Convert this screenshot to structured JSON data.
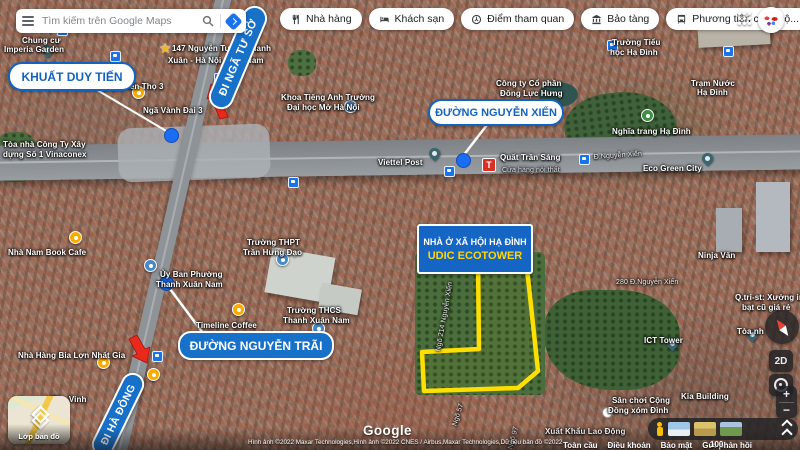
{
  "topbar": {
    "search_placeholder": "Tìm kiếm trên Google Maps",
    "chips": [
      {
        "icon": "restaurant-icon",
        "label": "Nhà hàng"
      },
      {
        "icon": "hotel-icon",
        "label": "Khách sạn"
      },
      {
        "icon": "attraction-icon",
        "label": "Điểm tham quan"
      },
      {
        "icon": "museum-icon",
        "label": "Bảo tàng"
      },
      {
        "icon": "transit-icon",
        "label": "Phương tiện công cộ..."
      }
    ],
    "more_label": "›"
  },
  "annotations": {
    "khuat_duy_tien": "KHUẤT DUY TIẾN",
    "di_nga_tu_so": "ĐI NGÃ TƯ SỞ",
    "duong_nguyen_xien": "ĐƯỜNG NGUYỄN XIỂN",
    "udic_line1": "NHÀ Ở XÃ HỘI HẠ ĐÌNH",
    "udic_line2": "UDIC ECOTOWER",
    "duong_nguyen_trai": "ĐƯỜNG NGUYỄN TRÃI",
    "di_ha_dong": "ĐI HÀ ĐÔNG"
  },
  "map_labels": [
    {
      "text": "Chung cư",
      "x": 22,
      "y": 36
    },
    {
      "text": "Imperia Garden",
      "x": 4,
      "y": 45
    },
    {
      "text": "Nhà sách Tiến Thọ 3",
      "x": 84,
      "y": 82
    },
    {
      "text": "Ngã Vành Đai 3",
      "x": 143,
      "y": 106
    },
    {
      "text": "Tòa nhà Công Ty Xây",
      "x": 3,
      "y": 140
    },
    {
      "text": "dựng Số 1 Vinaconex",
      "x": 3,
      "y": 150
    },
    {
      "text": "147 Nguyễn Tuân - Thanh",
      "x": 172,
      "y": 44
    },
    {
      "text": "Xuân - Hà Nội - Việt Nam",
      "x": 168,
      "y": 56
    },
    {
      "text": "Nhà Nam Book Cafe",
      "x": 8,
      "y": 248
    },
    {
      "text": "Ủy Ban Phường",
      "x": 160,
      "y": 270
    },
    {
      "text": "Thanh Xuân Nam",
      "x": 156,
      "y": 280
    },
    {
      "text": "Trường THPT",
      "x": 247,
      "y": 238
    },
    {
      "text": "Trần Hưng Đạo",
      "x": 243,
      "y": 248
    },
    {
      "text": "Timeline Coffee",
      "x": 196,
      "y": 321
    },
    {
      "text": "Trường THCS",
      "x": 287,
      "y": 306
    },
    {
      "text": "Thanh Xuân Nam",
      "x": 283,
      "y": 316
    },
    {
      "text": "Nhà Hàng Bia Lợn Nhất Gia",
      "x": 18,
      "y": 351
    },
    {
      "text": "The Vinh",
      "x": 52,
      "y": 395
    },
    {
      "text": "Công ty Cổ phần",
      "x": 496,
      "y": 79
    },
    {
      "text": "Đồng Lực Hưng",
      "x": 500,
      "y": 89
    },
    {
      "text": "Khoa Tiếng Anh Trường",
      "x": 281,
      "y": 93
    },
    {
      "text": "Đại học Mở Hà Nội",
      "x": 287,
      "y": 103
    },
    {
      "text": "Trường Tiểu",
      "x": 612,
      "y": 38
    },
    {
      "text": "học Hạ Đình",
      "x": 610,
      "y": 48
    },
    {
      "text": "Nghĩa trang Hạ Đình",
      "x": 612,
      "y": 127
    },
    {
      "text": "Eco Green City",
      "x": 643,
      "y": 164
    },
    {
      "text": "Trạm Nước",
      "x": 691,
      "y": 79
    },
    {
      "text": "Hạ Đình",
      "x": 697,
      "y": 88
    },
    {
      "text": "Ninja Văn",
      "x": 698,
      "y": 251
    },
    {
      "text": "280 Đ.Nguyễn Xiển",
      "x": 616,
      "y": 279,
      "cls": "road"
    },
    {
      "text": "Q.tri-st: Xưởng in",
      "x": 735,
      "y": 293
    },
    {
      "text": "bạt cũ giá rẻ",
      "x": 742,
      "y": 303
    },
    {
      "text": "ICT Tower",
      "x": 644,
      "y": 336
    },
    {
      "text": "Tòa nh",
      "x": 737,
      "y": 327
    },
    {
      "text": "Kia Building",
      "x": 681,
      "y": 392
    },
    {
      "text": "Sân chơi Cộng",
      "x": 612,
      "y": 396
    },
    {
      "text": "Đồng xóm Đình",
      "x": 608,
      "y": 406
    },
    {
      "text": "Xuất Khẩu Lao Động",
      "x": 545,
      "y": 427
    },
    {
      "text": "Viettel Post",
      "x": 378,
      "y": 158
    },
    {
      "text": "Quất Trần Sáng",
      "x": 500,
      "y": 153
    },
    {
      "text": "Cửa hàng nội thất",
      "x": 502,
      "y": 167,
      "cls": "sub"
    },
    {
      "text": "Đ.Nguyễn Xiển",
      "x": 594,
      "y": 154,
      "cls": "road",
      "rot": -4
    },
    {
      "text": "Ngõ 214 Nguyễn Xiển",
      "x": 442,
      "y": 345,
      "cls": "road",
      "rot": -80
    },
    {
      "text": "Ngõ 57",
      "x": 458,
      "y": 420,
      "cls": "road",
      "rot": -72
    },
    {
      "text": "Ngõ 97",
      "x": 514,
      "y": 443,
      "cls": "road",
      "rot": -75
    }
  ],
  "pins": [
    {
      "t": "teal",
      "x": 47,
      "y": 57
    },
    {
      "t": "teal",
      "x": 434,
      "y": 160
    },
    {
      "t": "teal",
      "x": 707,
      "y": 165
    },
    {
      "t": "teal",
      "x": 672,
      "y": 350
    },
    {
      "t": "teal",
      "x": 752,
      "y": 341
    },
    {
      "t": "star",
      "x": 166,
      "y": 49
    },
    {
      "t": "orange",
      "x": 75,
      "y": 237
    },
    {
      "t": "orange",
      "x": 138,
      "y": 92
    },
    {
      "t": "orange",
      "x": 238,
      "y": 309
    },
    {
      "t": "orange",
      "x": 103,
      "y": 362
    },
    {
      "t": "orange",
      "x": 153,
      "y": 374
    },
    {
      "t": "tree",
      "x": 647,
      "y": 115
    },
    {
      "t": "school",
      "x": 350,
      "y": 106
    },
    {
      "t": "school",
      "x": 318,
      "y": 328
    },
    {
      "t": "school",
      "x": 150,
      "y": 265
    },
    {
      "t": "school",
      "x": 282,
      "y": 259
    },
    {
      "t": "transit",
      "x": 62,
      "y": 30
    },
    {
      "t": "transit",
      "x": 115,
      "y": 56
    },
    {
      "t": "transit",
      "x": 219,
      "y": 78
    },
    {
      "t": "transit",
      "x": 293,
      "y": 182
    },
    {
      "t": "transit",
      "x": 449,
      "y": 171
    },
    {
      "t": "transit",
      "x": 612,
      "y": 45
    },
    {
      "t": "transit",
      "x": 728,
      "y": 51
    },
    {
      "t": "transit",
      "x": 584,
      "y": 159
    },
    {
      "t": "transit",
      "x": 157,
      "y": 356
    },
    {
      "t": "transit",
      "x": 110,
      "y": 422
    },
    {
      "t": "redT",
      "x": 488,
      "y": 164
    },
    {
      "t": "dot",
      "x": 462,
      "y": 159
    },
    {
      "t": "dot",
      "x": 165,
      "y": 282
    },
    {
      "t": "dot",
      "x": 170,
      "y": 134
    },
    {
      "t": "wdot",
      "x": 606,
      "y": 411
    }
  ],
  "layers_card": {
    "label": "Lớp bản đồ"
  },
  "right_controls": {
    "button_2d": "2D",
    "zoom_in": "+",
    "zoom_out": "−"
  },
  "footer": {
    "logo": "Google",
    "attribution": "Hình ảnh ©2022 Maxar Technologies,Hình ảnh ©2022 CNES / Airbus,Maxar Technologies,Dữ liệu bản đồ ©2022",
    "links": [
      "Toàn cầu",
      "Điều khoản",
      "Bảo mật",
      "Gửi phản hồi"
    ],
    "scale_label": "100 mét"
  },
  "colors": {
    "accent_blue": "#1a73e8",
    "label_blue": "#1565c4",
    "polygon_yellow": "#ffdf00",
    "arrow_red": "#e8291c",
    "udic_yellow": "#ffd600"
  }
}
